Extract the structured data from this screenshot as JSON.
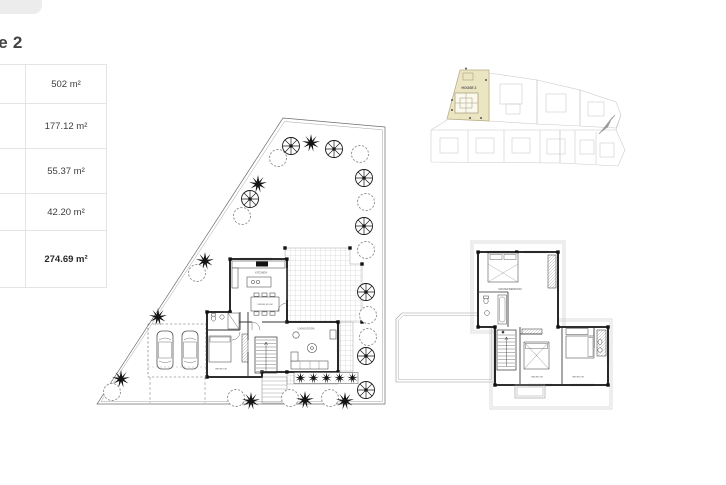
{
  "page": {
    "title": "House 2"
  },
  "area_table": {
    "rows": [
      {
        "label": "Plot Area",
        "value": "502 m²"
      },
      {
        "label": "Internal\nCovered\nArea",
        "value": "177.12 m²"
      },
      {
        "label": "Covered\nVeranda",
        "value": "55.37 m²"
      },
      {
        "label": "Covered\nParking",
        "value": "42.20 m²"
      },
      {
        "label": "Total\nCovered\nArea",
        "value": "274.69 m²"
      }
    ]
  },
  "ground_floor_plan": {
    "labels": {
      "kitchen": "KITCHEN",
      "dining": "DINING ROOM",
      "living": "LIVING ROOM",
      "bedroom": "BEDROOM"
    }
  },
  "upper_floor_plan": {
    "labels": {
      "master_bedroom": "MASTER BEDROOM",
      "bedroom_1": "BEDROOM",
      "bedroom_2": "BEDROOM"
    }
  },
  "site_plan": {
    "highlighted_house_label": "HOUSE 2",
    "highlight_color": "#ece5c2"
  }
}
